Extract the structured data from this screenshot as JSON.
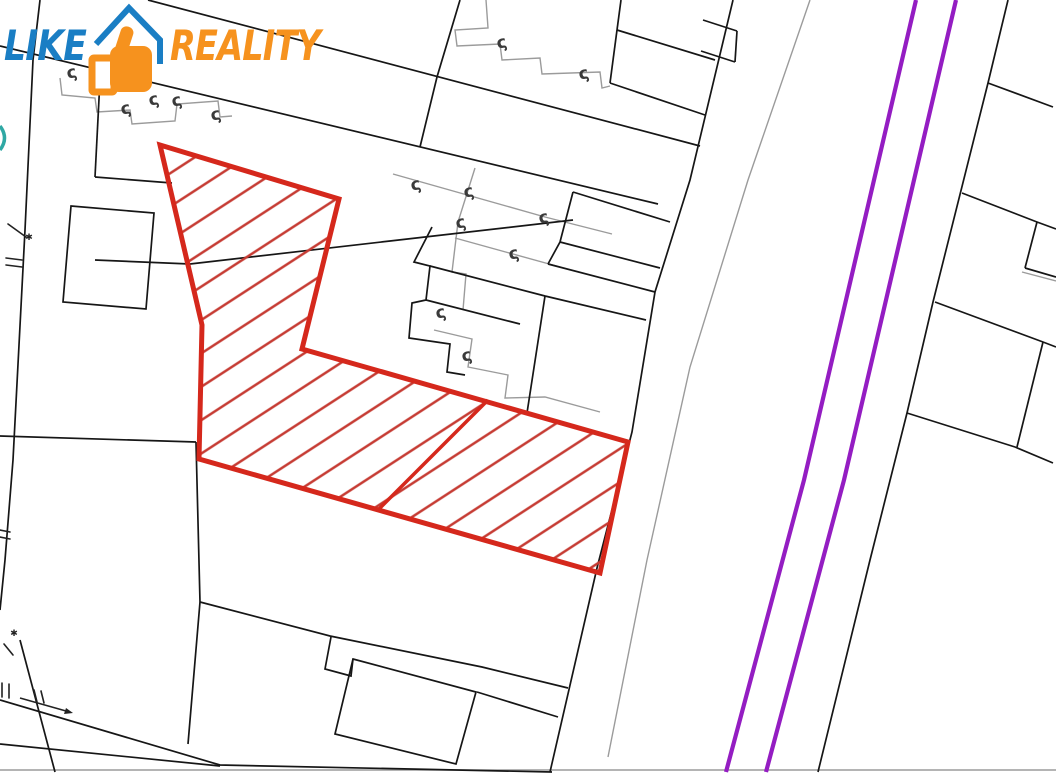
{
  "logo": {
    "like_text": "LIKE",
    "reality_text": "REALITY",
    "like_color": "#1a7ec4",
    "reality_color": "#f6921e",
    "icon": {
      "name": "thumb-up-house",
      "hand_color": "#f6921e",
      "roof_color": "#1a7ec4"
    }
  },
  "map": {
    "canvas": {
      "width": 1056,
      "height": 774,
      "background": "#ffffff"
    },
    "colors": {
      "parcel_line": "#161616",
      "building_line": "#9b9b9b",
      "highlight_border": "#d5281c",
      "highlight_hatch": "#c63c34",
      "road_marking": "#941dc2",
      "junction_symbol": "#3a3a3a",
      "water_symbol": "#2fa8a4",
      "survey_mark": "#222222"
    },
    "highlight_parcel": {
      "outline": [
        [
          160,
          145
        ],
        [
          339,
          199
        ],
        [
          302,
          349
        ],
        [
          628,
          442
        ],
        [
          600,
          573
        ],
        [
          199,
          459
        ],
        [
          202,
          325
        ]
      ],
      "divider": [
        [
          488,
          400
        ],
        [
          378,
          510
        ]
      ],
      "hatch_angle_deg": -33,
      "hatch_spacing": 28
    },
    "road_lines": [
      [
        [
          916,
          0
        ],
        [
          874,
          180
        ],
        [
          804,
          480
        ],
        [
          726,
          772
        ]
      ],
      [
        [
          956,
          0
        ],
        [
          914,
          180
        ],
        [
          844,
          480
        ],
        [
          766,
          772
        ]
      ]
    ],
    "boundary_lines": [
      [
        [
          148,
          0
        ],
        [
          700,
          146
        ]
      ],
      [
        [
          0,
          46
        ],
        [
          658,
          204
        ]
      ],
      [
        [
          733,
          0
        ],
        [
          690,
          180
        ],
        [
          655,
          292
        ],
        [
          632,
          432
        ],
        [
          597,
          568
        ],
        [
          550,
          772
        ]
      ],
      [
        [
          1008,
          0
        ],
        [
          988,
          83
        ],
        [
          933,
          302
        ],
        [
          907,
          413
        ],
        [
          870,
          560
        ],
        [
          818,
          772
        ]
      ],
      [
        [
          988,
          83
        ],
        [
          1053,
          107
        ]
      ],
      [
        [
          460,
          0
        ],
        [
          437,
          77
        ],
        [
          420,
          147
        ]
      ],
      [
        [
          621,
          0
        ],
        [
          617,
          30
        ]
      ],
      [
        [
          617,
          30
        ],
        [
          610,
          83
        ]
      ],
      [
        [
          617,
          30
        ],
        [
          715,
          60
        ]
      ],
      [
        [
          610,
          83
        ],
        [
          705,
          115
        ]
      ],
      [
        [
          703,
          20
        ],
        [
          737,
          31
        ]
      ],
      [
        [
          701,
          51
        ],
        [
          735,
          62
        ]
      ],
      [
        [
          737,
          31
        ],
        [
          735,
          62
        ]
      ],
      [
        [
          962,
          193
        ],
        [
          1037,
          222
        ],
        [
          1056,
          229
        ]
      ],
      [
        [
          1037,
          222
        ],
        [
          1025,
          268
        ]
      ],
      [
        [
          1025,
          268
        ],
        [
          1056,
          277
        ]
      ],
      [
        [
          935,
          302
        ],
        [
          1043,
          342
        ],
        [
          1056,
          347
        ]
      ],
      [
        [
          1043,
          342
        ],
        [
          1017,
          447
        ]
      ],
      [
        [
          907,
          413
        ],
        [
          1015,
          447
        ],
        [
          1053,
          463
        ]
      ],
      [
        [
          95,
          260
        ],
        [
          190,
          264
        ],
        [
          390,
          241
        ],
        [
          573,
          220
        ]
      ],
      [
        [
          0,
          436
        ],
        [
          196,
          442
        ]
      ],
      [
        [
          95,
          177
        ],
        [
          172,
          183
        ]
      ],
      [
        [
          40,
          0
        ],
        [
          33,
          60
        ],
        [
          25,
          230
        ],
        [
          13,
          460
        ],
        [
          5,
          560
        ],
        [
          0,
          610
        ]
      ],
      [
        [
          101,
          60
        ],
        [
          95,
          177
        ]
      ],
      [
        [
          196,
          442
        ],
        [
          200,
          602
        ],
        [
          188,
          744
        ]
      ],
      [
        [
          200,
          602
        ],
        [
          330,
          636
        ],
        [
          482,
          667
        ],
        [
          568,
          688
        ]
      ],
      [
        [
          0,
          700
        ],
        [
          220,
          765
        ],
        [
          552,
          772
        ]
      ],
      [
        [
          0,
          744
        ],
        [
          220,
          766
        ]
      ],
      [
        [
          20,
          640
        ],
        [
          55,
          772
        ]
      ],
      [
        [
          573,
          192
        ],
        [
          560,
          242
        ],
        [
          548,
          264
        ]
      ],
      [
        [
          573,
          192
        ],
        [
          670,
          222
        ]
      ],
      [
        [
          560,
          242
        ],
        [
          660,
          268
        ]
      ],
      [
        [
          548,
          264
        ],
        [
          655,
          292
        ]
      ],
      [
        [
          432,
          227
        ],
        [
          414,
          262
        ],
        [
          430,
          266
        ],
        [
          426,
          300
        ],
        [
          412,
          303
        ],
        [
          409,
          338
        ],
        [
          450,
          344
        ],
        [
          447,
          372
        ],
        [
          465,
          375
        ]
      ],
      [
        [
          430,
          266
        ],
        [
          545,
          296
        ]
      ],
      [
        [
          545,
          296
        ],
        [
          527,
          413
        ]
      ],
      [
        [
          545,
          296
        ],
        [
          646,
          320
        ]
      ],
      [
        [
          426,
          300
        ],
        [
          520,
          324
        ]
      ],
      [
        [
          331,
          637
        ],
        [
          325,
          669
        ],
        [
          351,
          676
        ],
        [
          353,
          659
        ]
      ],
      [
        [
          477,
          692
        ],
        [
          558,
          717
        ]
      ]
    ],
    "boundary_polygons": [
      [
        [
          71,
          206
        ],
        [
          154,
          213
        ],
        [
          146,
          309
        ],
        [
          63,
          302
        ]
      ],
      [
        [
          353,
          659
        ],
        [
          476,
          692
        ],
        [
          456,
          764
        ],
        [
          335,
          734
        ]
      ]
    ],
    "building_lines": [
      [
        [
          60,
          78
        ],
        [
          62,
          95
        ],
        [
          95,
          98
        ],
        [
          97,
          112
        ],
        [
          130,
          110
        ],
        [
          132,
          124
        ],
        [
          175,
          121
        ],
        [
          177,
          104
        ],
        [
          218,
          101
        ],
        [
          220,
          117
        ],
        [
          232,
          116
        ]
      ],
      [
        [
          486,
          0
        ],
        [
          488,
          28
        ],
        [
          455,
          30
        ],
        [
          457,
          46
        ],
        [
          500,
          44
        ],
        [
          502,
          60
        ],
        [
          540,
          58
        ],
        [
          542,
          74
        ],
        [
          600,
          72
        ],
        [
          602,
          88
        ],
        [
          610,
          86
        ]
      ],
      [
        [
          393,
          174
        ],
        [
          545,
          217
        ],
        [
          612,
          234
        ]
      ],
      [
        [
          455,
          238
        ],
        [
          560,
          267
        ]
      ],
      [
        [
          475,
          168
        ],
        [
          458,
          222
        ],
        [
          452,
          272
        ],
        [
          466,
          274
        ],
        [
          463,
          310
        ]
      ],
      [
        [
          434,
          330
        ],
        [
          472,
          339
        ],
        [
          468,
          367
        ],
        [
          508,
          375
        ],
        [
          505,
          398
        ],
        [
          545,
          397
        ],
        [
          600,
          412
        ]
      ],
      [
        [
          810,
          0
        ],
        [
          748,
          180
        ],
        [
          690,
          367
        ],
        [
          647,
          560
        ],
        [
          608,
          757
        ]
      ],
      [
        [
          0,
          770
        ],
        [
          1056,
          770
        ]
      ],
      [
        [
          1022,
          272
        ],
        [
          1056,
          281
        ]
      ]
    ],
    "water_arc": "M0,126 Q9,138 0,150",
    "junction_symbols": [
      [
        73,
        72
      ],
      [
        127,
        108
      ],
      [
        155,
        99
      ],
      [
        178,
        100
      ],
      [
        217,
        114
      ],
      [
        503,
        42
      ],
      [
        585,
        73
      ],
      [
        417,
        184
      ],
      [
        470,
        191
      ],
      [
        462,
        222
      ],
      [
        545,
        217
      ],
      [
        515,
        253
      ],
      [
        442,
        312
      ],
      [
        468,
        355
      ]
    ],
    "survey_marks": {
      "strokes": [
        [
          [
            6,
            258
          ],
          [
            22,
            260
          ]
        ],
        [
          [
            6,
            265
          ],
          [
            22,
            267
          ]
        ],
        [
          [
            8,
            224
          ],
          [
            26,
            237
          ]
        ],
        [
          [
            4,
            644
          ],
          [
            13,
            655
          ]
        ],
        [
          [
            0,
            530
          ],
          [
            10,
            532
          ]
        ],
        [
          [
            0,
            537
          ],
          [
            10,
            539
          ]
        ],
        [
          [
            34,
            690
          ],
          [
            37,
            702
          ]
        ],
        [
          [
            41,
            691
          ],
          [
            44,
            703
          ]
        ],
        [
          [
            2,
            683
          ],
          [
            2,
            697
          ]
        ],
        [
          [
            9,
            684
          ],
          [
            9,
            698
          ]
        ]
      ],
      "stars": [
        [
          29,
          240
        ],
        [
          14,
          636
        ]
      ],
      "arrow": {
        "line": [
          [
            20,
            698
          ],
          [
            66,
            711
          ]
        ],
        "head": [
          [
            73,
            713
          ],
          [
            66,
            708
          ],
          [
            64,
            714
          ]
        ]
      }
    }
  }
}
